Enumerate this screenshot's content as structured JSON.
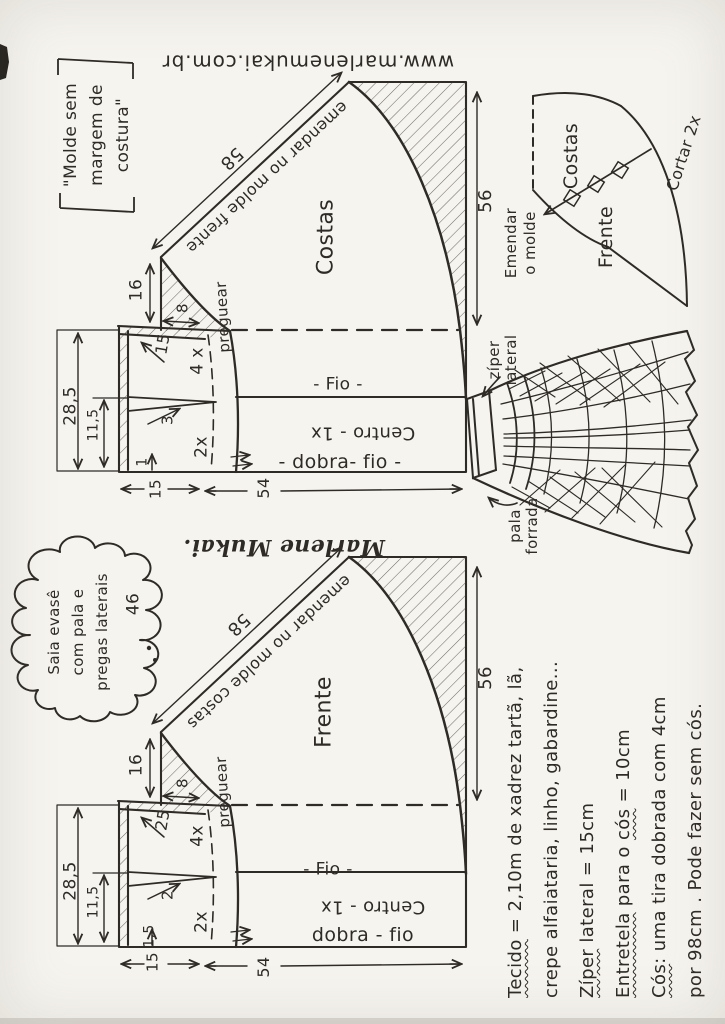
{
  "colors": {
    "ink": "#2e2b27",
    "paper": "#f6f4ef"
  },
  "url_text": "www.marlenemukai.com.br",
  "signature": "Marlene Mukai.",
  "note": {
    "l1": "\"Molde sem",
    "l2": "margem de",
    "l3": "costura\""
  },
  "cloud": {
    "l1": "Saia evasê",
    "l2": "com pala e",
    "l3": "pregas laterais",
    "size": "46"
  },
  "costas": {
    "name": "Costas",
    "join_note": "emendar no molde frente",
    "seam_len": "58",
    "side_len": "56",
    "hem_width": "54",
    "yoke_height_total": "28,5",
    "yoke_height_lower": "11,5",
    "pleat_height": "16",
    "pleat_width": "8",
    "pleat_note": "preguear",
    "upper_mark": "15",
    "dart": "3",
    "cut_four": "4 x",
    "cut_two": "2x",
    "corner_mark": "1",
    "yoke_width": "15",
    "grain_label": "- Fio -",
    "center_label": "Centro - 1x",
    "fold_label": "- dobra- fio -"
  },
  "frente": {
    "name": "Frente",
    "join_note": "emendar no molde costas",
    "seam_len": "58",
    "side_len": "56",
    "hem_width": "54",
    "yoke_height_total": "28,5",
    "yoke_height_lower": "11,5",
    "pleat_height": "16",
    "pleat_width": "8",
    "pleat_note": "preguear",
    "upper_mark": "25",
    "dart": "2",
    "cut_four": "4x",
    "cut_two": "2x",
    "corner_mark": "1,5",
    "yoke_width": "15",
    "grain_label": "- Fio -",
    "center_label": "Centro - 1x",
    "fold_label": "dobra - fio"
  },
  "fan": {
    "back": "Costas",
    "front": "Frente",
    "join1": "Emendar",
    "join2": "o molde",
    "cut": "Cortar 2x"
  },
  "sketch": {
    "zip1": "zíper",
    "zip2": "lateral",
    "yoke1": "pala",
    "yoke2": "forrada"
  },
  "instructions": {
    "lines": [
      {
        "a": "Tecido",
        "b": " = 2,10m de xadrez tartã, lã,",
        "c": "",
        "d": ""
      },
      {
        "a": "",
        "b": "crepe alfaiataria, linho, gabardine...",
        "c": "",
        "d": ""
      },
      {
        "a": "Zíper",
        "b": " lateral = 15cm",
        "c": "",
        "d": ""
      },
      {
        "a": "Entretela",
        "b": " para o ",
        "c": "cós",
        "d": " = 10cm"
      },
      {
        "a": "Cós",
        "b": ": uma tira dobrada com 4cm",
        "c": "",
        "d": ""
      },
      {
        "a": "",
        "b": "por 98cm . Pode fazer sem cós.",
        "c": "",
        "d": ""
      }
    ]
  }
}
